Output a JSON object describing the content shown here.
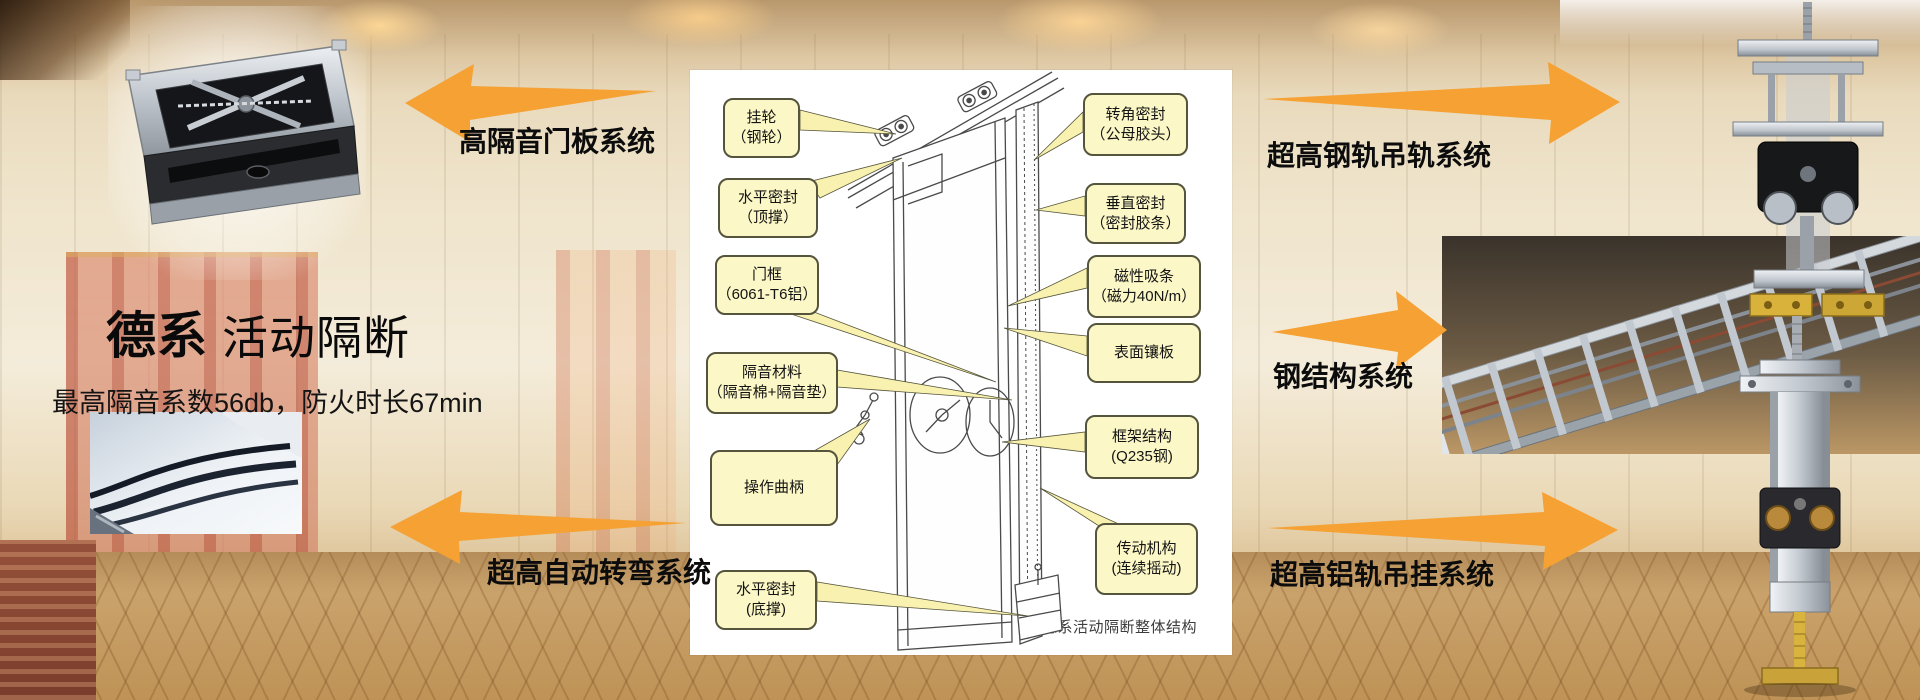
{
  "hero": {
    "brand": "德系",
    "brand_suffix": "活动隔断",
    "subtitle": "最高隔音系数56db，防火时长67min"
  },
  "systems": [
    {
      "label": "高隔音门板系统"
    },
    {
      "label": "超高自动转弯系统"
    },
    {
      "label": "超高钢轨吊轨系统"
    },
    {
      "label": "钢结构系统"
    },
    {
      "label": "超高铝轨吊挂系统"
    }
  ],
  "diagram": {
    "caption": "德系活动隔断整体结构",
    "left_callouts": [
      {
        "line1": "挂轮",
        "line2": "（钢轮）"
      },
      {
        "line1": "水平密封",
        "line2": "（顶撑）"
      },
      {
        "line1": "门框",
        "line2": "（6061-T6铝）"
      },
      {
        "line1": "隔音材料",
        "line2": "（隔音棉+隔音垫）"
      },
      {
        "line1": "操作曲柄",
        "line2": ""
      },
      {
        "line1": "水平密封",
        "line2": "(底撑)"
      }
    ],
    "right_callouts": [
      {
        "line1": "转角密封",
        "line2": "（公母胶头）"
      },
      {
        "line1": "垂直密封",
        "line2": "（密封胶条）"
      },
      {
        "line1": "磁性吸条",
        "line2": "（磁力40N/m）"
      },
      {
        "line1": "表面镶板",
        "line2": ""
      },
      {
        "line1": "框架结构",
        "line2": "(Q235钢)"
      },
      {
        "line1": "传动机构",
        "line2": "(连续摇动)"
      }
    ]
  },
  "photos": {
    "top_left": "door-panel-product-photo",
    "bottom_left": "curved-track-photo",
    "top_right": "steel-rail-hanger-photo",
    "middle_right": "steel-structure-frame-photo",
    "bottom_right": "aluminum-rail-hanger-photo"
  },
  "colors": {
    "arrow_orange": "#F5A134",
    "callout_fill": "#FBF7C6",
    "callout_border": "#55543C",
    "label_text": "#0C0C0C"
  }
}
